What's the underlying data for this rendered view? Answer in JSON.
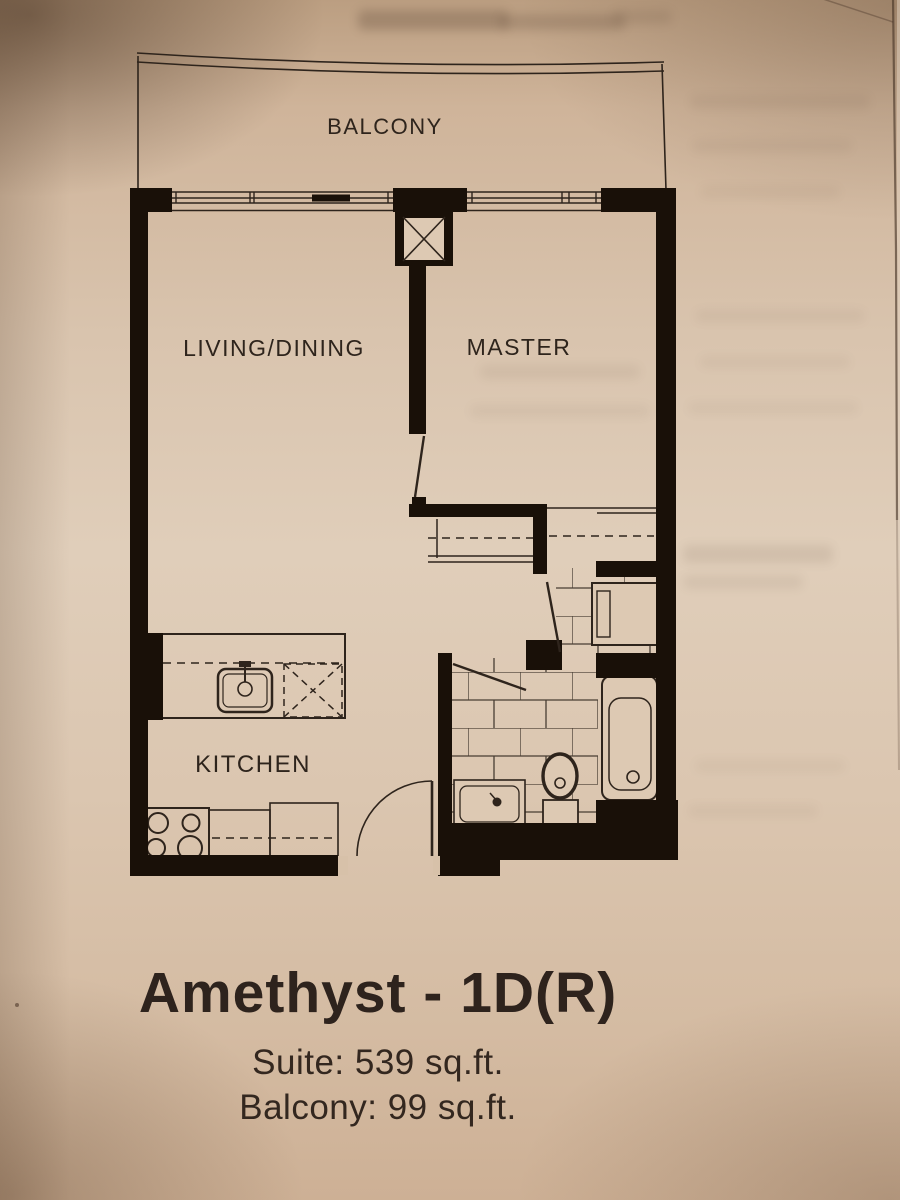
{
  "image": {
    "description": "Photograph of a printed condominium floor plan page",
    "paper_color": "#ddc9b3",
    "ink_color": "#2e241c",
    "wall_color": "#191008"
  },
  "floor_plan": {
    "rooms": [
      {
        "label": "BALCONY"
      },
      {
        "label": "LIVING/DINING"
      },
      {
        "label": "MASTER"
      },
      {
        "label": "KITCHEN"
      }
    ]
  },
  "title_block": {
    "plan_name": "Amethyst - 1D(R)",
    "suite_area": "Suite: 539 sq.ft.",
    "balcony_area": "Balcony: 99 sq.ft."
  }
}
